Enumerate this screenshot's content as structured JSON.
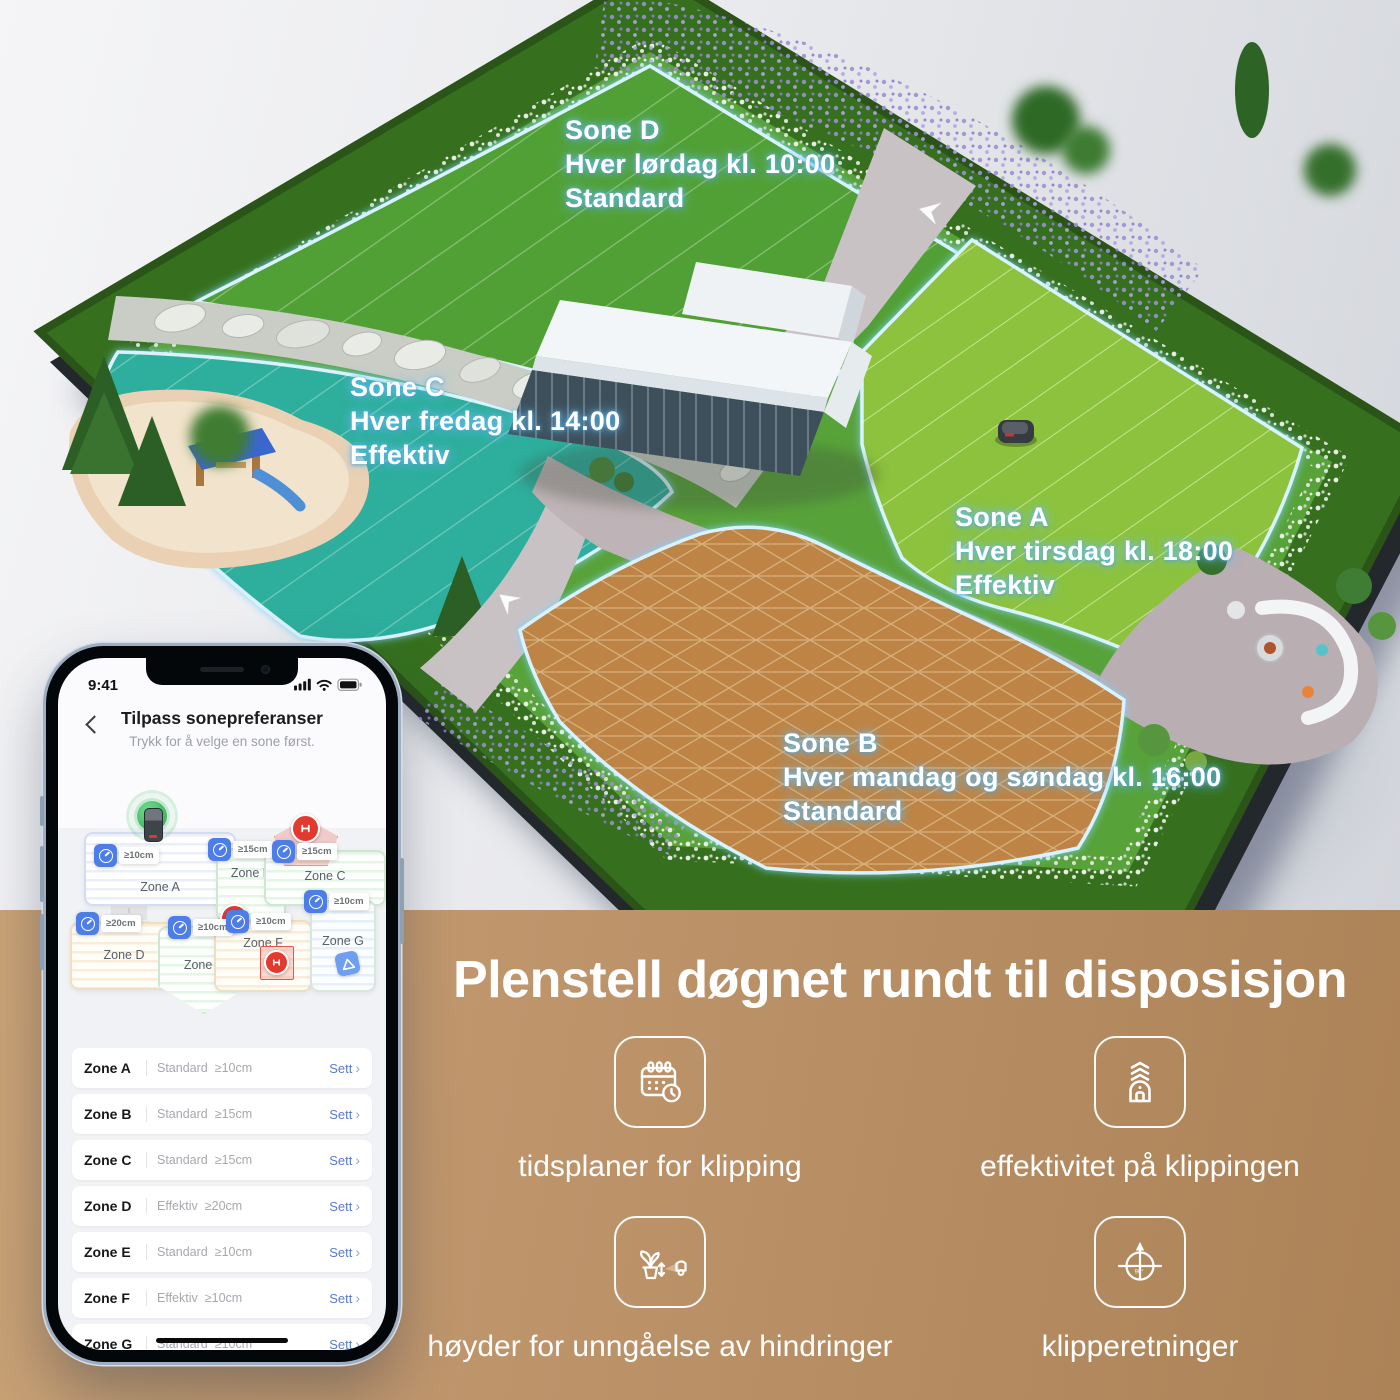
{
  "garden": {
    "zone_labels": [
      {
        "name": "Sone D",
        "schedule": "Hver lørdag kl. 10:00",
        "mode": "Standard"
      },
      {
        "name": "Sone C",
        "schedule": "Hver fredag kl. 14:00",
        "mode": "Effektiv"
      },
      {
        "name": "Sone A",
        "schedule": "Hver tirsdag kl. 18:00",
        "mode": "Effektiv"
      },
      {
        "name": "Sone B",
        "schedule": "Hver mandag og søndag kl. 16:00",
        "mode": "Standard"
      }
    ],
    "colors": {
      "sone_d": "#51a035",
      "sone_c": "#2fae9d",
      "sone_a": "#8cc23c",
      "sone_b": "#bd8445",
      "border_glow": "#aee4ff"
    }
  },
  "phone": {
    "status_bar": {
      "time": "9:41"
    },
    "header": {
      "title": "Tilpass sonepreferanser",
      "subtitle": "Trykk for å velge en sone først."
    },
    "map": {
      "zones": [
        {
          "label": "Zone A",
          "tag": "≥10cm"
        },
        {
          "label": "Zone B",
          "tag": "≥15cm"
        },
        {
          "label": "Zone C",
          "tag": "≥15cm"
        },
        {
          "label": "Zone D",
          "tag": "≥20cm"
        },
        {
          "label": "Zone E",
          "tag": "≥10cm"
        },
        {
          "label": "Zone F",
          "tag": "≥10cm"
        },
        {
          "label": "Zone G",
          "tag": "≥10cm"
        }
      ],
      "charger_bolt": "⚡"
    },
    "zone_list": {
      "action_label": "Sett",
      "chevron": "›",
      "rows": [
        {
          "zone": "Zone A",
          "mode": "Standard",
          "height": "≥10cm"
        },
        {
          "zone": "Zone B",
          "mode": "Standard",
          "height": "≥15cm"
        },
        {
          "zone": "Zone C",
          "mode": "Standard",
          "height": "≥15cm"
        },
        {
          "zone": "Zone D",
          "mode": "Effektiv",
          "height": "≥20cm"
        },
        {
          "zone": "Zone E",
          "mode": "Standard",
          "height": "≥10cm"
        },
        {
          "zone": "Zone F",
          "mode": "Effektiv",
          "height": "≥10cm"
        },
        {
          "zone": "Zone G",
          "mode": "Standard",
          "height": "≥10cm"
        }
      ]
    }
  },
  "promo": {
    "headline": "Plenstell døgnet rundt til disposisjon",
    "features": [
      {
        "icon": "calendar-clock-icon",
        "label": "tidsplaner for klipping"
      },
      {
        "icon": "mower-efficiency-icon",
        "label": "effektivitet på klippingen"
      },
      {
        "icon": "obstacle-height-icon",
        "label": "høyder for unngåelse av hindringer"
      },
      {
        "icon": "mow-direction-icon",
        "label": "klipperetninger",
        "angle_label": "90°"
      }
    ],
    "colors": {
      "band_bg": "#bc9068",
      "headline_text": "#ffffff"
    }
  }
}
